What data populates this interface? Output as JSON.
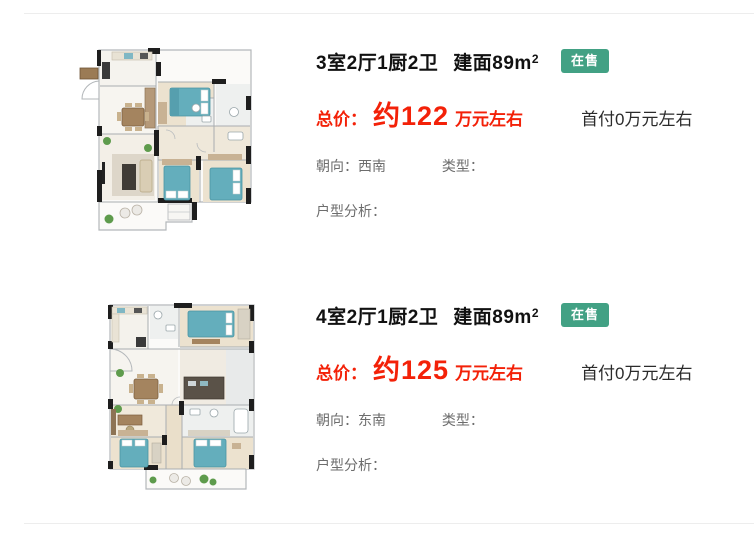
{
  "page": {
    "background": "#ffffff"
  },
  "colors": {
    "divider": "#ededed",
    "title_dark": "#111111",
    "price_red": "#f32108",
    "badge_green": "#42a184",
    "detail_gray": "#6d6d6d",
    "downpayment_dark": "#2b2b2b",
    "bed_teal": "#64aebc",
    "wood_floor": "#ece2cf"
  },
  "listings": [
    {
      "title_rooms": "3室2厅1厨2卫",
      "title_area": "建面89m",
      "area_sup": "2",
      "status_badge": "在售",
      "price_label": "总价：",
      "price_value": "约122",
      "price_suffix": "万元左右",
      "down_payment": "首付0万元左右",
      "orientation_label": "朝向：",
      "orientation_value": "西南",
      "type_label": "类型：",
      "type_value": "",
      "analysis_label": "户型分析：",
      "analysis_value": ""
    },
    {
      "title_rooms": "4室2厅1厨2卫",
      "title_area": "建面89m",
      "area_sup": "2",
      "status_badge": "在售",
      "price_label": "总价：",
      "price_value": "约125",
      "price_suffix": "万元左右",
      "down_payment": "首付0万元左右",
      "orientation_label": "朝向：",
      "orientation_value": "东南",
      "type_label": "类型：",
      "type_value": "",
      "analysis_label": "户型分析：",
      "analysis_value": ""
    }
  ]
}
